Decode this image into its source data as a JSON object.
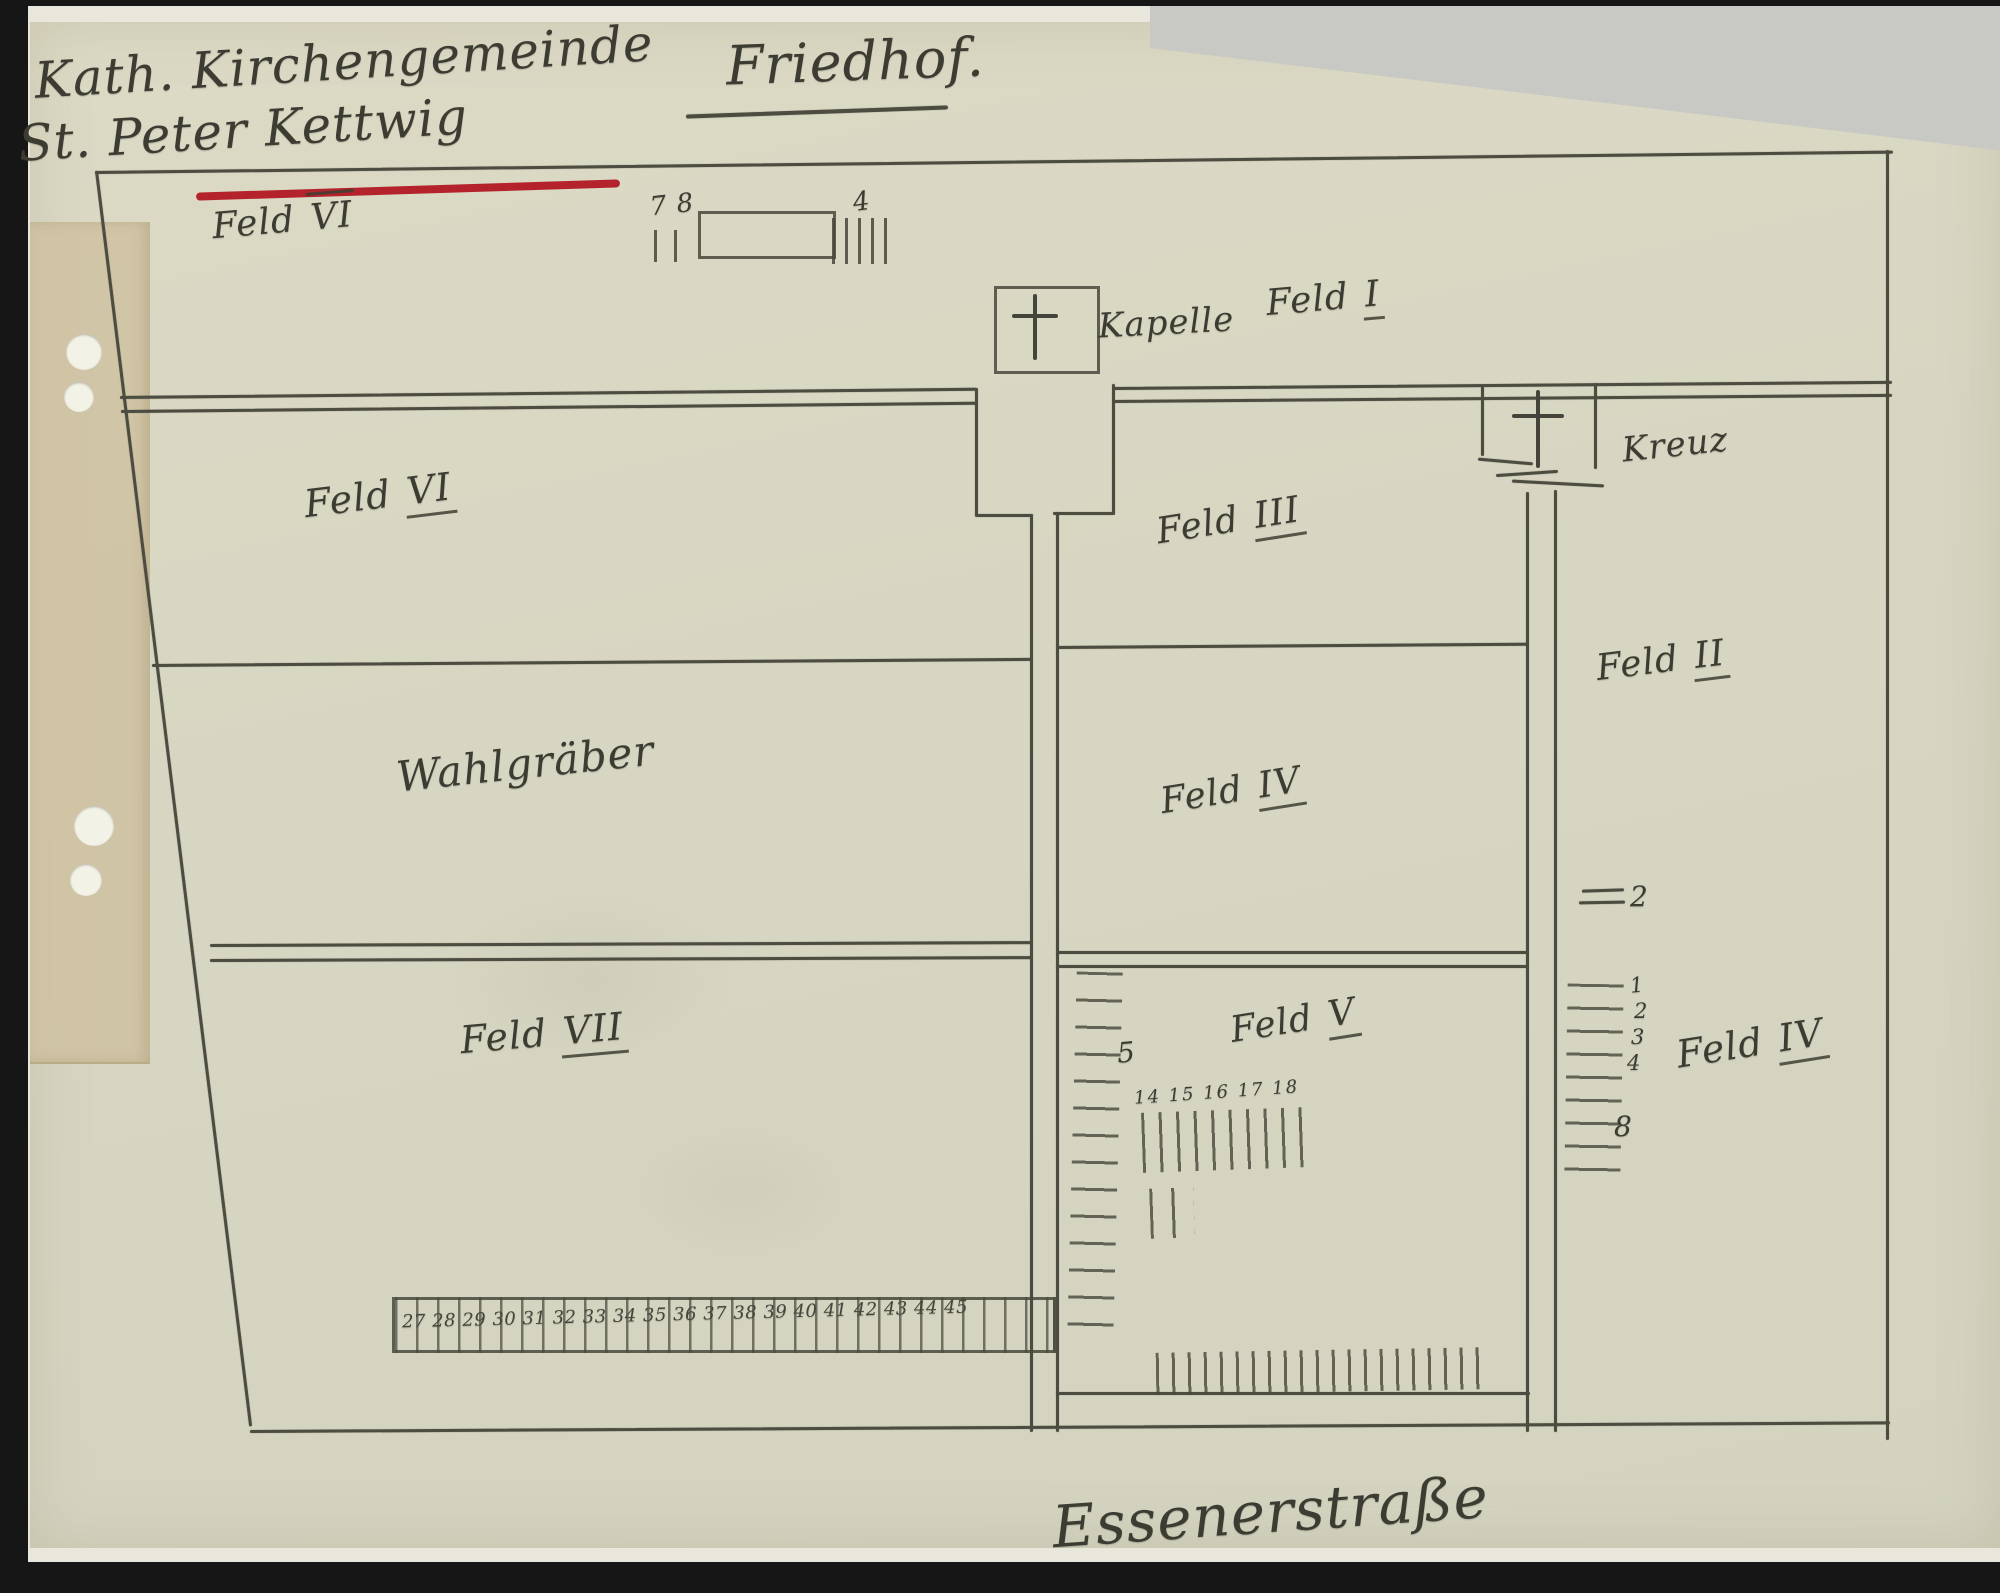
{
  "document": {
    "header": {
      "line1": "Kath. Kirchengemeinde",
      "line2": "St. Peter Kettwig",
      "title": "Friedhof."
    },
    "scale": {
      "left_numbers": "7 8",
      "right_number": "4"
    },
    "fields": {
      "strip_left": {
        "word": "Feld",
        "num": "VI"
      },
      "strip_right": {
        "word": "Feld",
        "num": "I"
      },
      "chapel_label": "Kapelle",
      "cross_label": "Kreuz",
      "row1_left": {
        "word": "Feld",
        "num": "VI"
      },
      "row1_mid": {
        "word": "Feld",
        "num": "III"
      },
      "right_upper": {
        "word": "Feld",
        "num": "II"
      },
      "row2_left": "Wahlgräber",
      "row2_mid": {
        "word": "Feld",
        "num": "IV"
      },
      "row3_left": {
        "word": "Feld",
        "num": "VII"
      },
      "row3_mid": {
        "word": "Feld",
        "num": "V"
      },
      "right_lower": {
        "word": "Feld",
        "num": "IV"
      }
    },
    "graves": {
      "feld5_side_label": "5",
      "feld5_row_numbers": "14 15 16 17 18",
      "feld2_row_label": "2",
      "feld4_row_labels": [
        "1",
        "2",
        "3",
        "4"
      ],
      "feld4_bottom_label": "8",
      "bottom_row_numbers": "27 28 29 30 31 32 33 34 35 36 37 38 39 40 41 42 43 44 45"
    },
    "footer": {
      "street_name": "Essenerstraße"
    },
    "colors": {
      "paper": "#d8d7c3",
      "pencil": "#4c4c41",
      "red_underline": "#b4232c",
      "tape": "#cfc1a0"
    }
  }
}
